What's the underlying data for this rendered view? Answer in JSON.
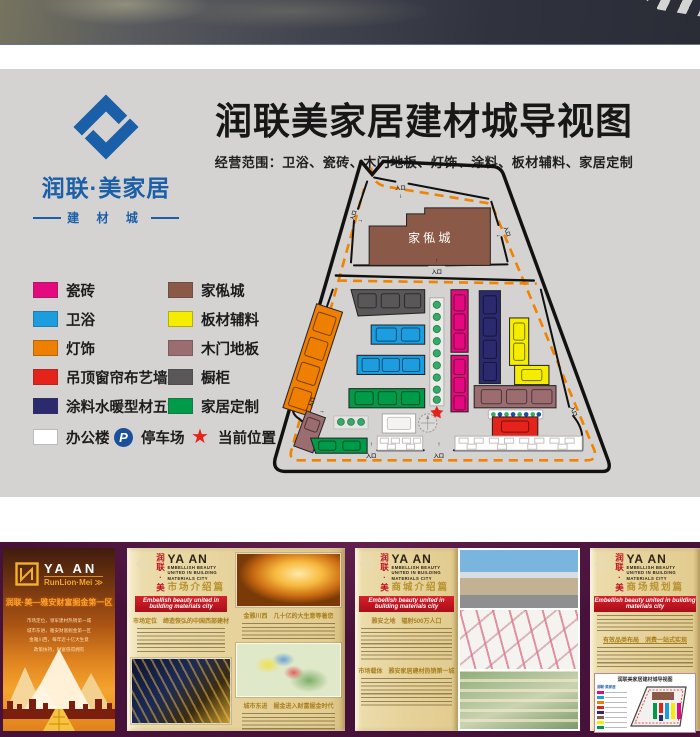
{
  "poster": {
    "brand": {
      "name": "润联·美家居",
      "tagline": "建 材 城",
      "color": "#1a5fa8"
    },
    "title": "润联美家居建材城导视图",
    "scope": "经营范围：卫浴、瓷砖、木门地板、灯饰、涂料、板材辅料、家居定制",
    "legend": {
      "col1": [
        {
          "label": "瓷砖",
          "color": "#e5097f"
        },
        {
          "label": "卫浴",
          "color": "#1b9de0"
        },
        {
          "label": "灯饰",
          "color": "#ee7f01"
        },
        {
          "label": "吊顶窗帘布艺墙纸",
          "color": "#e5231b"
        },
        {
          "label": "涂料水暖型材五金",
          "color": "#2b2a6e"
        }
      ],
      "col2": [
        {
          "label": "家俬城",
          "color": "#8a5947"
        },
        {
          "label": "板材辅料",
          "color": "#f5ec00"
        },
        {
          "label": "木门地板",
          "color": "#9b6c70"
        },
        {
          "label": "橱柜",
          "color": "#595757"
        },
        {
          "label": "家居定制",
          "color": "#009b48"
        }
      ],
      "office": {
        "label": "办公楼",
        "color": "#ffffff"
      },
      "parking": {
        "label": "停车场",
        "icon": "P",
        "color": "#1b4f9c"
      },
      "current": {
        "label": "当前位置",
        "color": "#e5231b"
      }
    },
    "map": {
      "building": "家俬城",
      "entrance": "入口"
    }
  },
  "footer": {
    "brand": {
      "cn": "润联·美",
      "en": "YA AN",
      "sub1": "EMBELLISH BEAUTY",
      "sub2": "UNITED IN BUILDING",
      "sub3": "MATERIALS CITY"
    },
    "banner": "Embellish beauty united in building materials city",
    "panel1": {
      "en": "YA AN",
      "sub": "RunLion·Mei",
      "arrow": "≫",
      "headline": "润联·美—雅安财富掘金第一区",
      "lines": [
        "市场定位，领军建材热销第一城",
        "城市东进，雅安财富掘金第一区",
        "金雅川西，每年近十亿大生意",
        "政策扶持，财富值得拥有"
      ]
    },
    "panel2": {
      "title": "市场介绍篇",
      "h1": "市场定位　缔造恢弘的中国西部建材盛景",
      "h2": "金雅川西　几十亿的大生意等着您",
      "h3": "城市东进　掘金进入财富掘金时代"
    },
    "panel3": {
      "title": "商城介绍篇",
      "h1": "雅安之地　辐射500万人口",
      "h2": "市场载体　雅安家居建材热销第一城"
    },
    "panel4": {
      "title": "商场规划篇",
      "h1": "有效品类布局　消费一站式实现",
      "minimap_title": "润联美家居建材城导视图",
      "minimap_logo": "润联·美家居"
    }
  }
}
